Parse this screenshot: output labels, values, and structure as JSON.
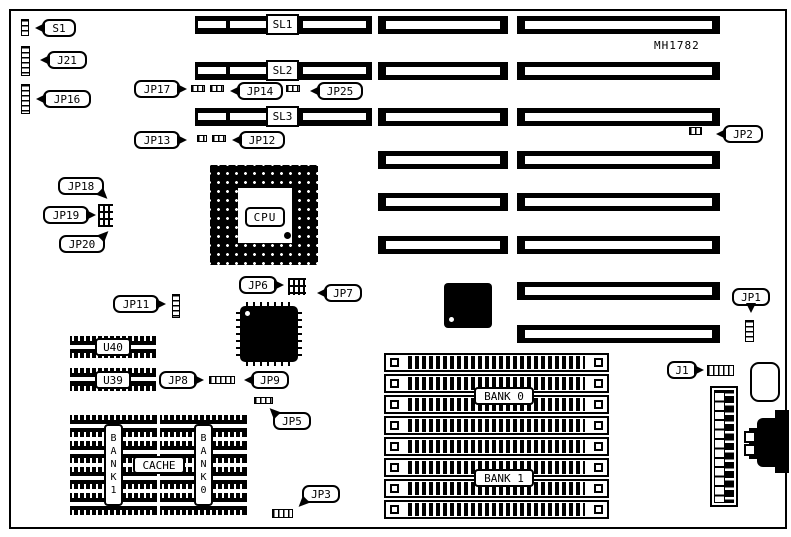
{
  "board": {
    "part_number": "MH1782"
  },
  "slots": {
    "sl1": "SL1",
    "sl2": "SL2",
    "sl3": "SL3"
  },
  "callouts": {
    "s1": "S1",
    "j21": "J21",
    "jp16": "JP16",
    "jp17": "JP17",
    "jp14": "JP14",
    "jp25": "JP25",
    "jp13": "JP13",
    "jp12": "JP12",
    "jp2": "JP2",
    "jp18": "JP18",
    "jp19": "JP19",
    "jp20": "JP20",
    "jp11": "JP11",
    "jp6": "JP6",
    "jp7": "JP7",
    "jp1": "JP1",
    "jp8": "JP8",
    "jp9": "JP9",
    "jp5": "JP5",
    "jp3": "JP3",
    "j1": "J1"
  },
  "chips": {
    "cpu": "CPU",
    "u40": "U40",
    "u39": "U39"
  },
  "memory": {
    "bank0_label": "BANK 0",
    "bank1_label": "BANK 1",
    "cache_label": "CACHE",
    "bank1_column": "BANK1",
    "bank0_column": "BANK0"
  },
  "colors": {
    "ink": "#000000",
    "paper": "#ffffff"
  }
}
